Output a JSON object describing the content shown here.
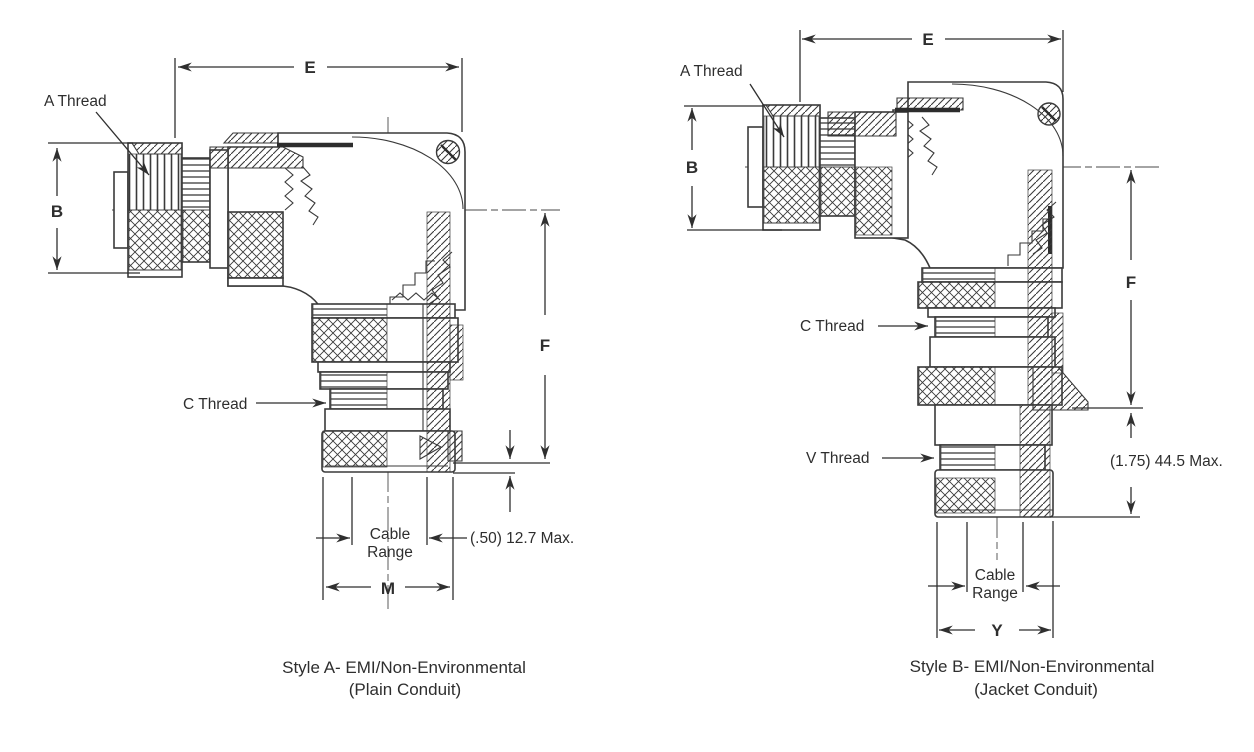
{
  "drawing": {
    "figure_a": {
      "caption_line1": "Style A- EMI/Non-Environmental",
      "caption_line2": "(Plain Conduit)",
      "label_a_thread": "A Thread",
      "label_c_thread": "C Thread",
      "dim_e": "E",
      "dim_b": "B",
      "dim_f": "F",
      "dim_m": "M",
      "cable_range_line1": "Cable",
      "cable_range_line2": "Range",
      "note_max": "(.50) 12.7 Max."
    },
    "figure_b": {
      "caption_line1": "Style B- EMI/Non-Environmental",
      "caption_line2": "(Jacket Conduit)",
      "label_a_thread": "A Thread",
      "label_c_thread": "C Thread",
      "label_v_thread": "V Thread",
      "dim_e": "E",
      "dim_b": "B",
      "dim_f": "F",
      "dim_y": "Y",
      "cable_range_line1": "Cable",
      "cable_range_line2": "Range",
      "note_max": "(1.75) 44.5 Max."
    },
    "colors": {
      "line": "#3a3a3a",
      "text": "#2e2e2e",
      "background": "#ffffff"
    }
  }
}
